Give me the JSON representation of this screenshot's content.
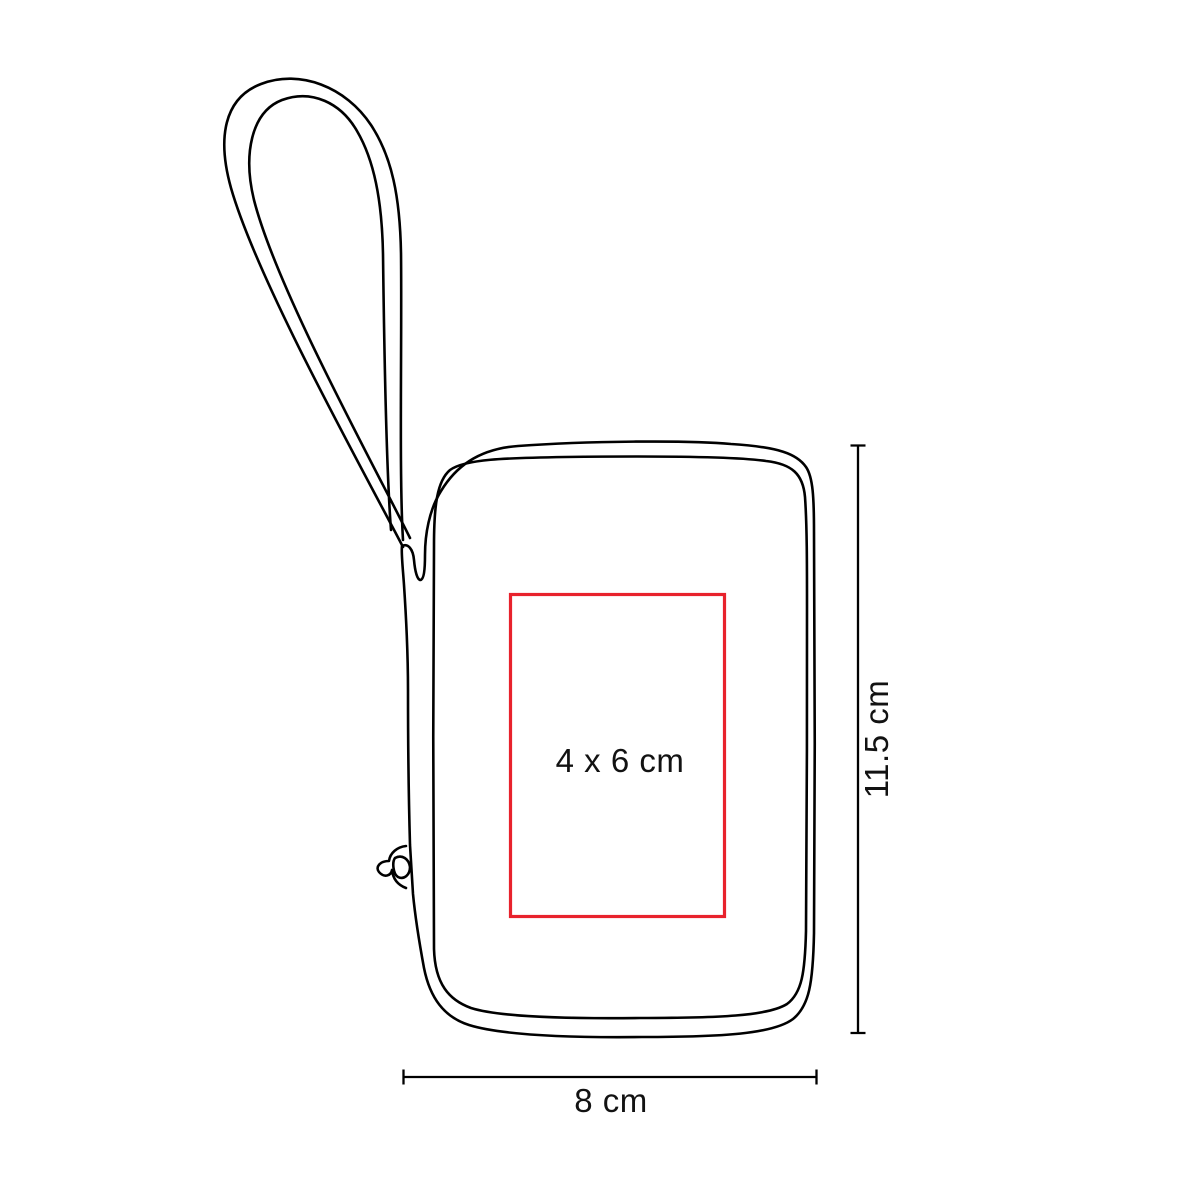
{
  "diagram": {
    "background": "#ffffff",
    "line_color": "#000000",
    "figure_icon": "pouch-with-wrist-strap-outline-icon",
    "print_area": {
      "label": "4 x 6 cm",
      "color": "#e8222c"
    },
    "dimensions": [
      {
        "axis": "height",
        "label": "11.5 cm"
      },
      {
        "axis": "width",
        "label": "8 cm"
      }
    ]
  }
}
